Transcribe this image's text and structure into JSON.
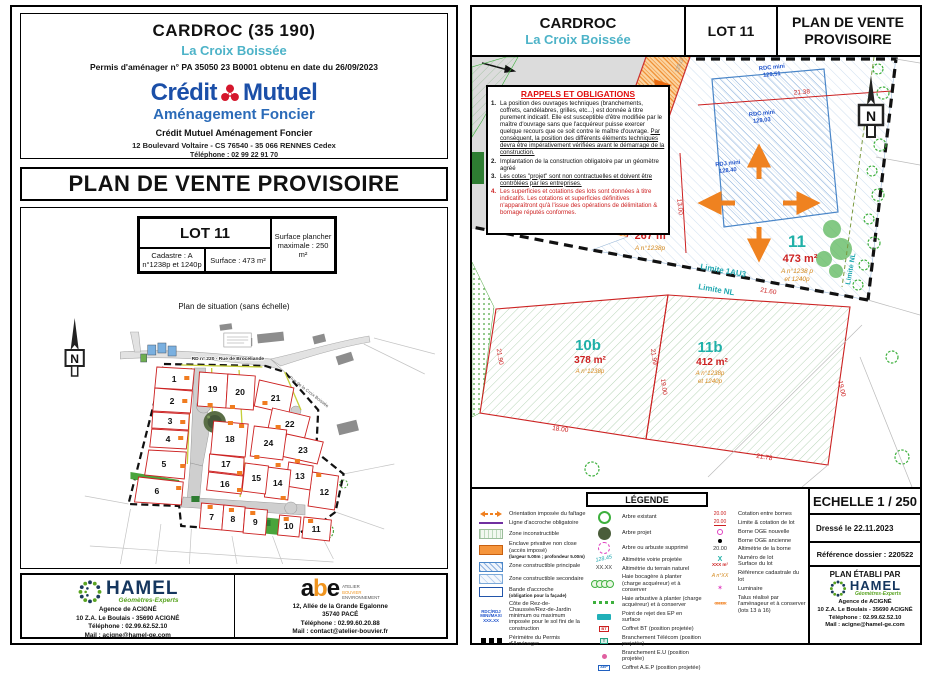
{
  "left": {
    "header": {
      "title": "CARDROC (35 190)",
      "subtitle": "La Croix Boissée",
      "permit": "Permis d'aménager n° PA 35050 23 B0001 obtenu en date du 26/09/2023",
      "brand_w1": "Crédit",
      "brand_w2": "Mutuel",
      "brand_sub": "Aménagement Foncier",
      "org": "Crédit Mutuel Aménagement Foncier",
      "address": "12 Boulevard Voltaire - CS 76540 - 35 066 RENNES Cedex",
      "phone": "Téléphone : 02 99 22 91 70"
    },
    "title": "PLAN DE VENTE PROVISOIRE",
    "table": {
      "lot": "LOT 11",
      "cadastre": "Cadastre : A n°1238p et 1240p",
      "surface": "Surface : 473 m²",
      "max": "Surface plancher maximale : 250 m²"
    },
    "caption": "Plan de situation (sans échelle)",
    "map": {
      "north": "N",
      "road1": "RD  n° 220 - Rue de Brocéliande",
      "road2": "Rue de la Croix Boissée",
      "lots": [
        "1",
        "2",
        "3",
        "4",
        "5",
        "6",
        "7",
        "8",
        "9",
        "10",
        "11",
        "12",
        "13",
        "14",
        "15",
        "16",
        "17",
        "18",
        "19",
        "20",
        "21",
        "22",
        "23",
        "24"
      ]
    },
    "footer": {
      "hamel": {
        "name": "HAMEL",
        "tagline": "Géomètres-Experts",
        "line1": "Agence de ACIGNÉ",
        "line2": "10 Z.A. Le Boulais - 35690 ACIGNÉ",
        "line3": "Téléphone : 02.99.62.52.10",
        "line4": "Mail : acigne@hamel-ge.com"
      },
      "abe": {
        "name_a": "a",
        "name_b": "b",
        "name_e": "e",
        "stack1": "ATELIER",
        "stack2": "BOUVIER",
        "stack3": "ENVIRONNEMENT",
        "line1": "12, Allée de la Grande Egalonne",
        "line2": "35740 PACÉ",
        "line3": "Téléphone : 02.99.60.20.88",
        "line4": "Mail : contact@atelier-bouvier.fr"
      }
    }
  },
  "right": {
    "header": {
      "title": "CARDROC",
      "subtitle": "La Croix Boissée",
      "lot": "LOT 11",
      "plan_title1": "PLAN DE VENTE",
      "plan_title2": "PROVISOIRE"
    },
    "obligations": {
      "title": "RAPPELS ET OBLIGATIONS",
      "n1": "1.",
      "i1a": "La position des ouvrages techniques (branchements, coffrets, candélabres, grilles, etc...) est donnée à titre purement indicatif. Elle est susceptible d'être modifiée par le maître d'ouvrage sans que l'acquéreur puisse exercer quelque recours que ce soit contre le maître d'ouvrage. ",
      "i1b": "Par conséquent, la position des différents éléments techniques devra être impérativement vérifiées avant le démarrage de la construction.",
      "n2": "2.",
      "i2": "Implantation de la construction obligatoire par un géomètre agréé",
      "n3": "3.",
      "i3": "Les cotes \"projet\" sont non contractuelles et doivent être contrôlées par les entreprises.",
      "n4": "4.",
      "i4": "Les superficies et cotations des lots sont données à titre indicatifs. Les cotations et superficies définitives n'apparaîtront qu'à l'issue des opérations de délimitation & bornage réputés conformes."
    },
    "plan": {
      "north": "N",
      "lot10": {
        "num": "10",
        "surf": "267 m²",
        "cad": "A n°1238p"
      },
      "lot11": {
        "num": "11",
        "surf": "473 m²",
        "cad1": "A n°1238 p",
        "cad2": "et 1240p"
      },
      "lot10b": {
        "num": "10b",
        "surf": "378 m²",
        "cad": "A n°1238p"
      },
      "lot11b": {
        "num": "11b",
        "surf": "412 m²",
        "cad1": "A n°1238p",
        "cad2": "et 1240p"
      },
      "rdc1a": "RDC mini",
      "rdc1b": "129.51",
      "rdc2a": "RDC mini",
      "rdc2b": "129.03",
      "rdja": "RDJ mini",
      "rdjb": "128.40",
      "lim1": "Limite 1AU3",
      "lim2": "Limite NL",
      "lim3": "Limite NL",
      "d1": "21.38",
      "d2": "21.60",
      "d3": "21.90",
      "d4": "18.00",
      "d5": "21.99",
      "d6": "19.00",
      "d7": "21.78",
      "d8": "13.00",
      "d9": "19.00",
      "alt1": "128.45",
      "alt2": "129.07"
    },
    "legend": {
      "title": "LÉGENDE",
      "c1": [
        {
          "label": "Orientation imposée du faîtage"
        },
        {
          "label": "Ligne d'accroche obligatoire"
        },
        {
          "label": "Zone inconstructible"
        },
        {
          "label": "Enclave privative non close (accès imposé)",
          "sub": "(largeur 5.00m ; profondeur 5.00m)"
        },
        {
          "label": "Zone constructible principale"
        },
        {
          "label": "Zone constructible secondaire"
        },
        {
          "label": "Bande d'accroche",
          "sub": "(obligation pour la façade)"
        },
        {
          "s1": "RDC/RDJ",
          "s2": "MINI/MAXI",
          "s3": "XXX.XX",
          "label": "Côte de Rez-de-Chaussée/Rez-de-Jardin minimum ou maximum imposée pour le sol fini de la construction"
        },
        {
          "label": "Périmètre du Permis d'Aménager"
        }
      ],
      "c2": [
        {
          "label": "Arbre existant"
        },
        {
          "label": "Arbre projet"
        },
        {
          "label": "Arbre ou arbuste supprimé"
        },
        {
          "sym": "128.45",
          "label": "Altimétrie voirie projetée"
        },
        {
          "sym": "XX.XX",
          "label": "Altimétrie du terrain naturel"
        },
        {
          "label": "Haie bocagère à planter (charge acquéreur) et à conserver"
        },
        {
          "label": "Haie arbustive à planter (charge acquéreur) et à conserver"
        },
        {
          "label": "Point de rejet des EP en surface"
        },
        {
          "sym": "BT",
          "label": "Coffret BT (position projetée)"
        },
        {
          "sym": "T",
          "label": "Branchement Télécom (position projetée)"
        },
        {
          "label": "Branchement E.U (position projetée)"
        },
        {
          "sym": "AEP",
          "label": "Coffret A.E.P (position projetée)"
        }
      ],
      "c3": [
        {
          "sym": "20.00",
          "label": "Cotation entre bornes"
        },
        {
          "sym": "20.00",
          "label": "Limite & cotation de lot"
        },
        {
          "label": "Borne OGE nouvelle"
        },
        {
          "label": "Borne OGE ancienne"
        },
        {
          "sym": "20.00",
          "label": "Altimétrie de la borne"
        },
        {
          "symx": "X",
          "syms": "XXX m²",
          "label": "Numéro de lot",
          "sub": "Surface du lot"
        },
        {
          "sym": "A n°XX",
          "label": "Référence cadastrale du lot"
        },
        {
          "label": "Luminaire"
        },
        {
          "label": "Talus réalisé par l'aménageur et à conserver (lots 13 à 16)"
        }
      ]
    },
    "block": {
      "scale": "ECHELLE 1 / 250",
      "date": "Dressé le 22.11.2023",
      "ref": "Référence dossier : 220522",
      "author": "PLAN ÉTABLI PAR",
      "hamel": {
        "name": "HAMEL",
        "tagline": "Géomètres-Experts",
        "line1": "Agence de ACIGNÉ",
        "line2": "10 Z.A. Le Boulais - 35690 ACIGNÉ",
        "line3": "Téléphone : 02.99.62.52.10",
        "line4": "Mail : acigne@hamel-ge.com"
      }
    }
  }
}
